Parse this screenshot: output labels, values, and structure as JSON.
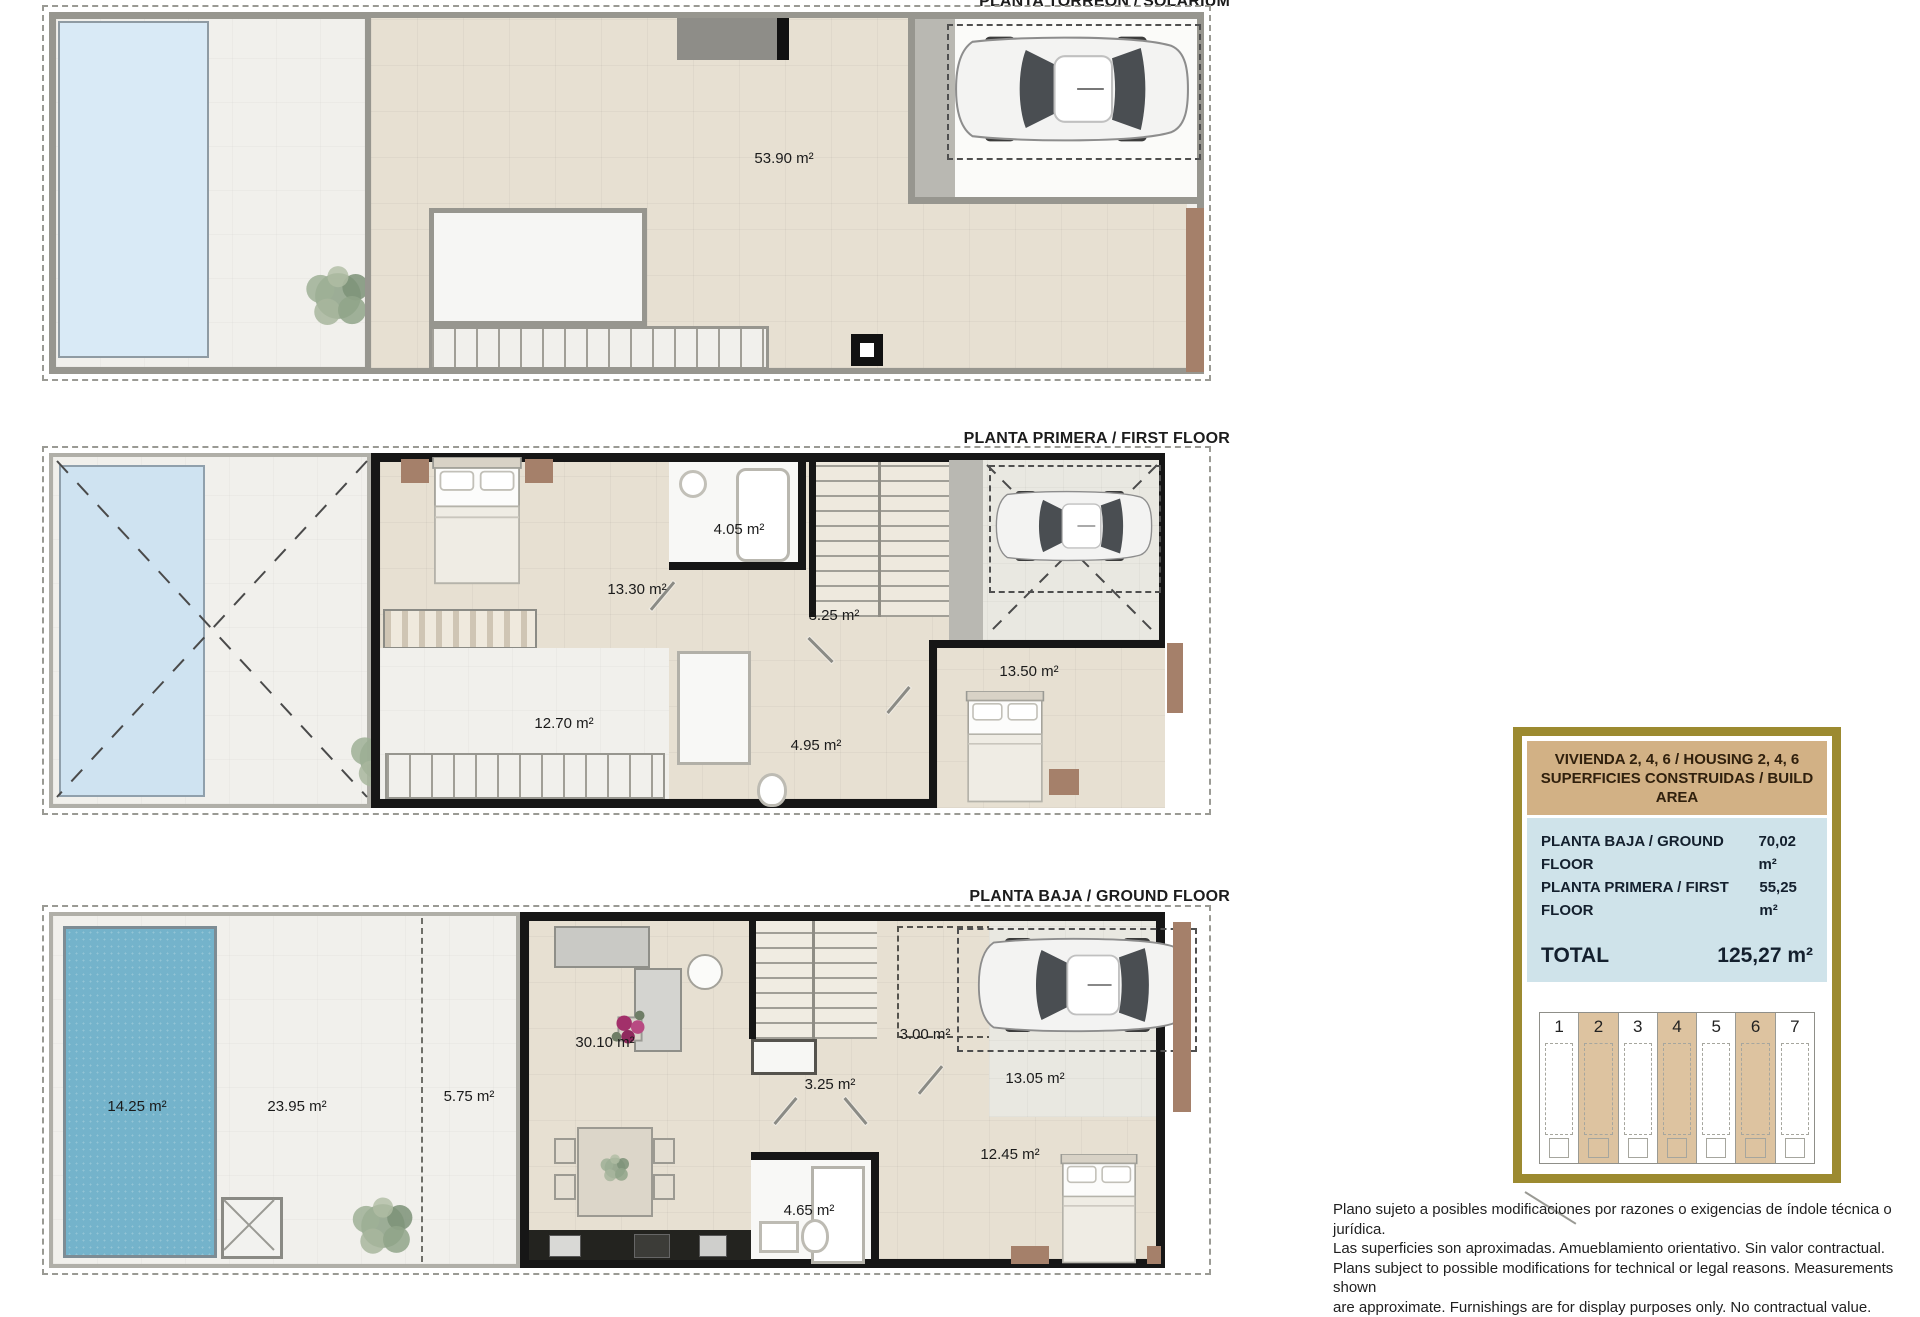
{
  "plans": {
    "solarium": {
      "title": "PLANTA TORREÓN / SOLARIUM",
      "rooms": {
        "solarium": "53.90 m²"
      }
    },
    "first_floor": {
      "title": "PLANTA PRIMERA / FIRST FLOOR",
      "rooms": {
        "bath": "4.05 m²",
        "bedroom1": "13.30 m²",
        "hall": "3.25 m²",
        "bedroom2": "13.50 m²",
        "terrace": "12.70 m²",
        "bath2": "4.95 m²"
      }
    },
    "ground_floor": {
      "title": "PLANTA BAJA / GROUND FLOOR",
      "rooms": {
        "pool": "14.25 m²",
        "terrace": "23.95 m²",
        "porch": "5.75 m²",
        "living": "30.10 m²",
        "hall": "3.25 m²",
        "entry": "3.00 m²",
        "parking": "13.05 m²",
        "bedroom": "12.45 m²",
        "bath": "4.65 m²"
      }
    }
  },
  "panel": {
    "title_line1": "VIVIENDA 2, 4, 6 / HOUSING 2, 4, 6",
    "title_line2": "SUPERFICIES CONSTRUIDAS / BUILD AREA",
    "rows": [
      {
        "label": "PLANTA BAJA / GROUND FLOOR",
        "value": "70,02 m²"
      },
      {
        "label": "PLANTA PRIMERA / FIRST FLOOR",
        "value": "55,25 m²"
      }
    ],
    "total_label": "TOTAL",
    "total_value": "125,27 m²",
    "site_units": [
      "1",
      "2",
      "3",
      "4",
      "5",
      "6",
      "7"
    ],
    "highlighted_units": [
      "2",
      "4",
      "6"
    ]
  },
  "disclaimer": {
    "lines": [
      "Plano sujeto a posibles modificaciones por razones o exigencias de índole técnica o jurídica.",
      "Las superficies son aproximadas. Amueblamiento orientativo. Sin valor contractual.",
      "Plans subject to possible modifications for technical or legal reasons. Measurements shown",
      "are approximate. Furnishings are for display purposes only. No contractual value."
    ]
  },
  "colors": {
    "panel_border_gold": "#9c8a30",
    "panel_header_tan": "#d2b185",
    "panel_info_blue": "#cfe3ea",
    "unit_highlight_tan": "#ddc3a0",
    "pool_solarium": "#d9eaf6",
    "pool_first_floor": "#cfe3f1",
    "pool_ground": "#74b3cb",
    "floor_beige": "#e7e0d2",
    "outer_wall_grey": "#97968f",
    "inner_wall_black": "#161616",
    "wood_brown": "#a5806a"
  }
}
